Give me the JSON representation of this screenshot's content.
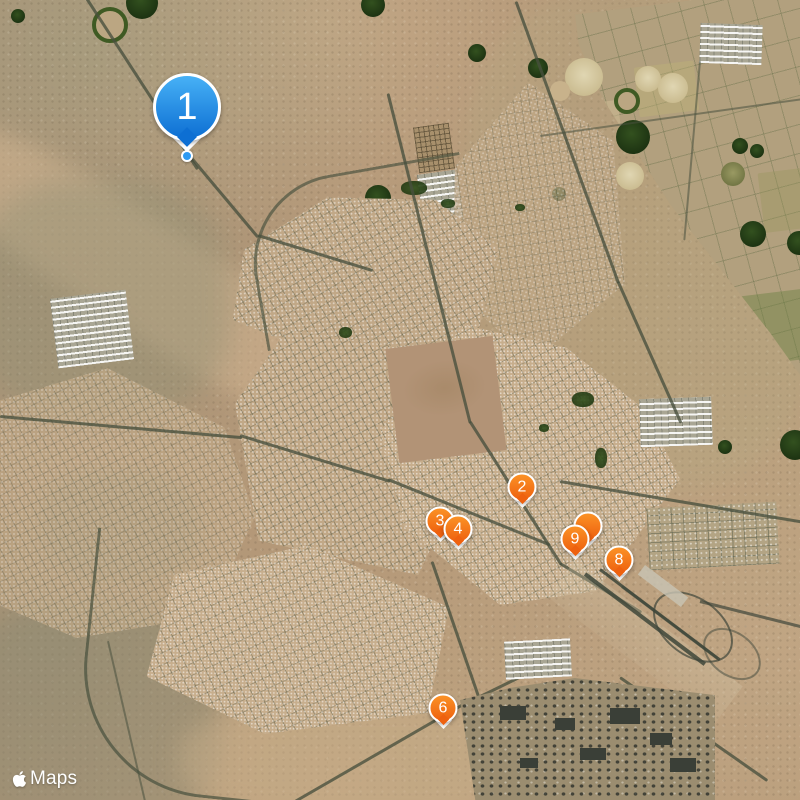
{
  "map": {
    "view_type": "satellite",
    "attribution": {
      "provider": "Maps",
      "logo": "apple-logo-icon"
    },
    "colors": {
      "primary_marker_top": "#47b1f6",
      "primary_marker_bottom": "#0d6fd3",
      "stop_marker_top": "#fb9226",
      "stop_marker_bottom": "#ee610f",
      "marker_border": "#ffffff",
      "marker_text": "#ffffff",
      "anchor_dot": "#2e9af2"
    },
    "markers": [
      {
        "label": "2",
        "x": 522,
        "y": 487,
        "kind": "stop"
      },
      {
        "label": "3",
        "x": 440,
        "y": 521,
        "kind": "stop"
      },
      {
        "label": "4",
        "x": 458,
        "y": 529,
        "kind": "stop"
      },
      {
        "label": "",
        "x": 588,
        "y": 526,
        "kind": "stop",
        "occluded_by": "9"
      },
      {
        "label": "9",
        "x": 575,
        "y": 539,
        "kind": "stop"
      },
      {
        "label": "8",
        "x": 619,
        "y": 560,
        "kind": "stop"
      },
      {
        "label": "6",
        "x": 443,
        "y": 708,
        "kind": "stop"
      },
      {
        "label": "1",
        "x": 187,
        "y": 107,
        "kind": "primary",
        "anchor_dot": true
      }
    ]
  }
}
